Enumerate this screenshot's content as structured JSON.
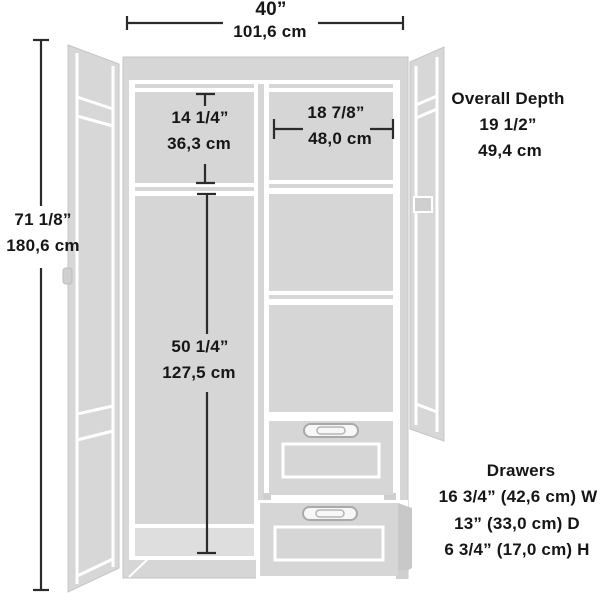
{
  "diagram": {
    "product": "wardrobe storage cabinet dimension diagram",
    "colors": {
      "cabinet_fill": "#d6d6d6",
      "cabinet_fill_light": "#dedede",
      "cabinet_fill_dark": "#c8c8c8",
      "groove": "#ffffff",
      "dimension_line": "#2b2b2b",
      "text": "#161616",
      "background": "#ffffff"
    },
    "dimensions": {
      "overall_width": {
        "in": "40”",
        "cm": "101,6 cm"
      },
      "overall_height": {
        "in": "71 1/8”",
        "cm": "180,6 cm"
      },
      "upper_left_compartment": {
        "in": "14 1/4”",
        "cm": "36,3 cm"
      },
      "upper_right_compartment": {
        "in": "18 7/8”",
        "cm": "48,0 cm"
      },
      "overall_depth": {
        "label": "Overall Depth",
        "in": "19 1/2”",
        "cm": "49,4 cm"
      },
      "hanging_section": {
        "in": "50 1/4”",
        "cm": "127,5 cm"
      },
      "drawers": {
        "label": "Drawers",
        "width": "16 3/4” (42,6 cm) W",
        "depth": "13” (33,0 cm) D",
        "height": "6 3/4” (17,0 cm) H"
      }
    }
  }
}
